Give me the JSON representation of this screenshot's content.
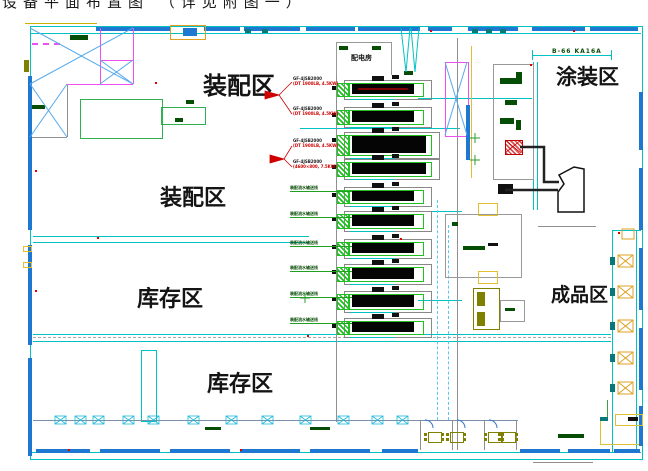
{
  "title_partial": "设备平面布置图 （详见附图一）",
  "zones": {
    "assembly_top": "装配区",
    "assembly_mid": "装配区",
    "storage_mid": "库存区",
    "storage_bottom": "库存区",
    "painting": "涂装区",
    "finished": "成品区",
    "power_room": "配电房"
  },
  "crane_label": "B-66 KA16A",
  "production_line_count": 10,
  "line_annotations": [
    {
      "code": "GF-4JSB2000",
      "spec": "(DT 1900LB, 4.5KW)"
    },
    {
      "code": "GF-4JSB2000",
      "spec": "(DT 1900LB, 4.5KW)"
    },
    {
      "code": "GF-4JSB2000",
      "spec": "(DT 1900LB, 4.5KW)"
    },
    {
      "code": "GF-4JSB2000",
      "spec": "(4600×800, 7.5KW)"
    }
  ],
  "line_labels": [
    "装配流水输送线",
    "装配流水输送线",
    "装配流水输送线",
    "装配流水输送线",
    "装配流水输送线",
    "装配流水输送线"
  ],
  "colors": {
    "wall_cyan": "#00c2c2",
    "window_blue": "#1e78d2",
    "machine_green": "#1fc01f",
    "bar_black": "#050505",
    "annotation_red": "#d00000",
    "brace_blue": "#55aaee",
    "magenta": "#f050f0",
    "orange": "#e0a020",
    "olive": "#808000",
    "yellow": "#e0c030"
  }
}
